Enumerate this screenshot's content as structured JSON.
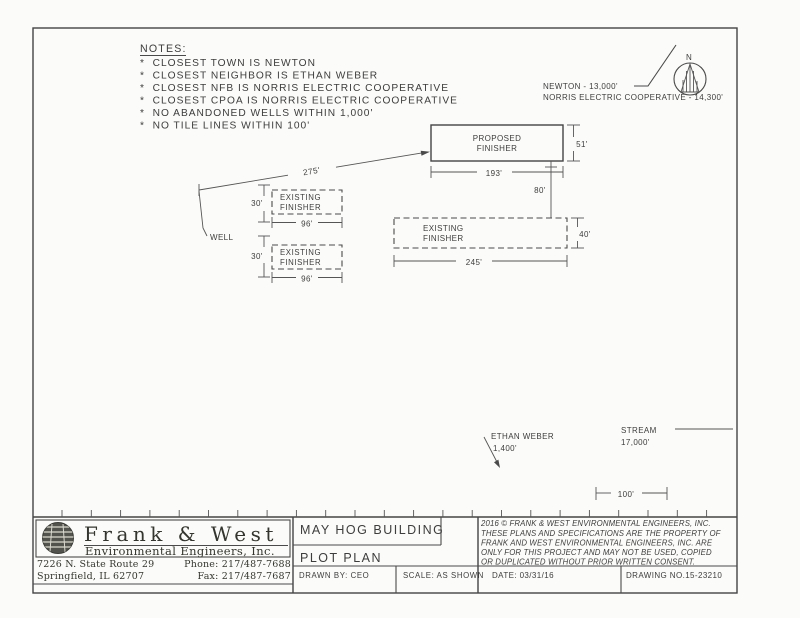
{
  "notes": {
    "title": "NOTES:",
    "items": [
      "*  CLOSEST TOWN IS NEWTON",
      "*  CLOSEST NEIGHBOR IS ETHAN WEBER",
      "*  CLOSEST NFB IS NORRIS ELECTRIC COOPERATIVE",
      "*  CLOSEST CPOA IS NORRIS ELECTRIC COOPERATIVE",
      "*  NO ABANDONED WELLS WITHIN 1,000'",
      "*  NO TILE LINES WITHIN 100'"
    ]
  },
  "compass": {
    "north": "N",
    "newton": "NEWTON - 13,000'",
    "norris": "NORRIS ELECTRIC COOPERATIVE - 14,300'"
  },
  "plot": {
    "proposed": {
      "line1": "PROPOSED",
      "line2": "FINISHER",
      "width": "193'",
      "depth": "51'"
    },
    "existing_right": {
      "line1": "EXISTING",
      "line2": "FINISHER",
      "width": "245'",
      "depth": "40'"
    },
    "existing_left_top": {
      "line1": "EXISTING",
      "line2": "FINISHER",
      "width": "96'",
      "setback": "30'"
    },
    "existing_left_bottom": {
      "line1": "EXISTING",
      "line2": "FINISHER",
      "width": "96'",
      "setback": "30'"
    },
    "separation": "80'",
    "well_distance": "275'",
    "well": "WELL",
    "ethan": {
      "line1": "ETHAN WEBER",
      "line2": "1,400'"
    },
    "stream": {
      "line1": "STREAM",
      "line2": "17,000'"
    },
    "scale_bar": "100'"
  },
  "title_block": {
    "company": {
      "name": "Frank & West",
      "subtitle": "Environmental Engineers, Inc.",
      "address1": "7226 N. State Route 29",
      "address2": "Springfield, IL 62707",
      "phone": "Phone: 217/487-7688",
      "fax": "Fax: 217/487-7687"
    },
    "project": "MAY HOG BUILDING",
    "sheet": "PLOT PLAN",
    "drawn_by": "DRAWN BY: CEO",
    "scale": "SCALE: AS SHOWN",
    "date": "DATE: 03/31/16",
    "drawing_no": "DRAWING NO.15-23210",
    "copyright": [
      "2016 © FRANK & WEST ENVIRONMENTAL ENGINEERS, INC.",
      "THESE PLANS AND SPECIFICATIONS ARE THE PROPERTY OF",
      "FRANK AND WEST ENVIRONMENTAL ENGINEERS, INC. ARE",
      "ONLY FOR THIS PROJECT AND MAY NOT BE USED, COPIED",
      "OR DUPLICATED WITHOUT PRIOR WRITTEN CONSENT."
    ]
  },
  "colors": {
    "ink": "#3d3d3d",
    "paper": "#fbfbf9"
  }
}
